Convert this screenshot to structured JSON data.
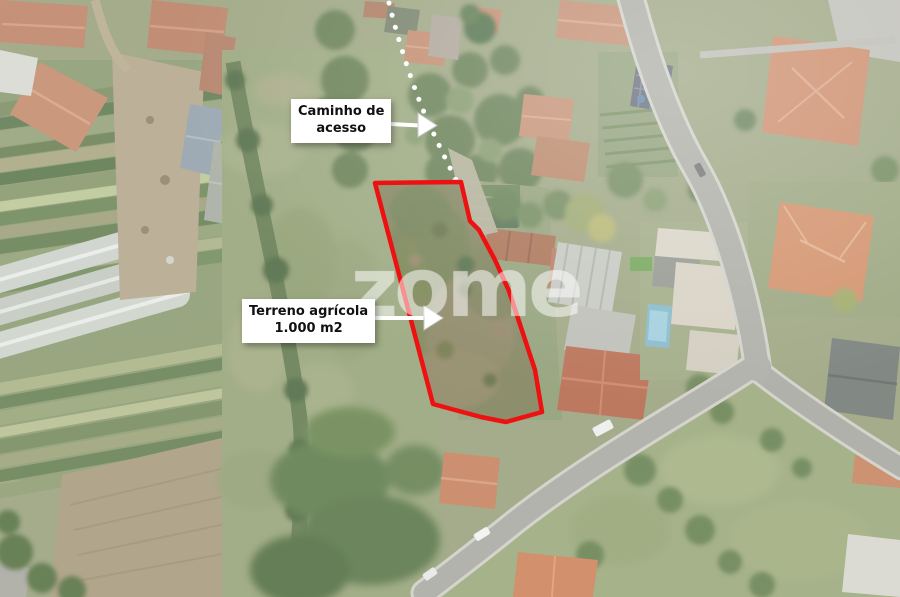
{
  "page": {
    "width": 900,
    "height": 597
  },
  "annotations": {
    "access_path_label": {
      "line1": "Caminho de",
      "line2": "acesso"
    },
    "parcel_label": {
      "line1": "Terreno agrícola",
      "line2": "1.000 m2"
    }
  },
  "watermark": "zome",
  "colors": {
    "parcel_outline": "#ee1111",
    "dotted_path": "#ffffff",
    "label_background": "#ffffff",
    "label_text": "#111111"
  }
}
